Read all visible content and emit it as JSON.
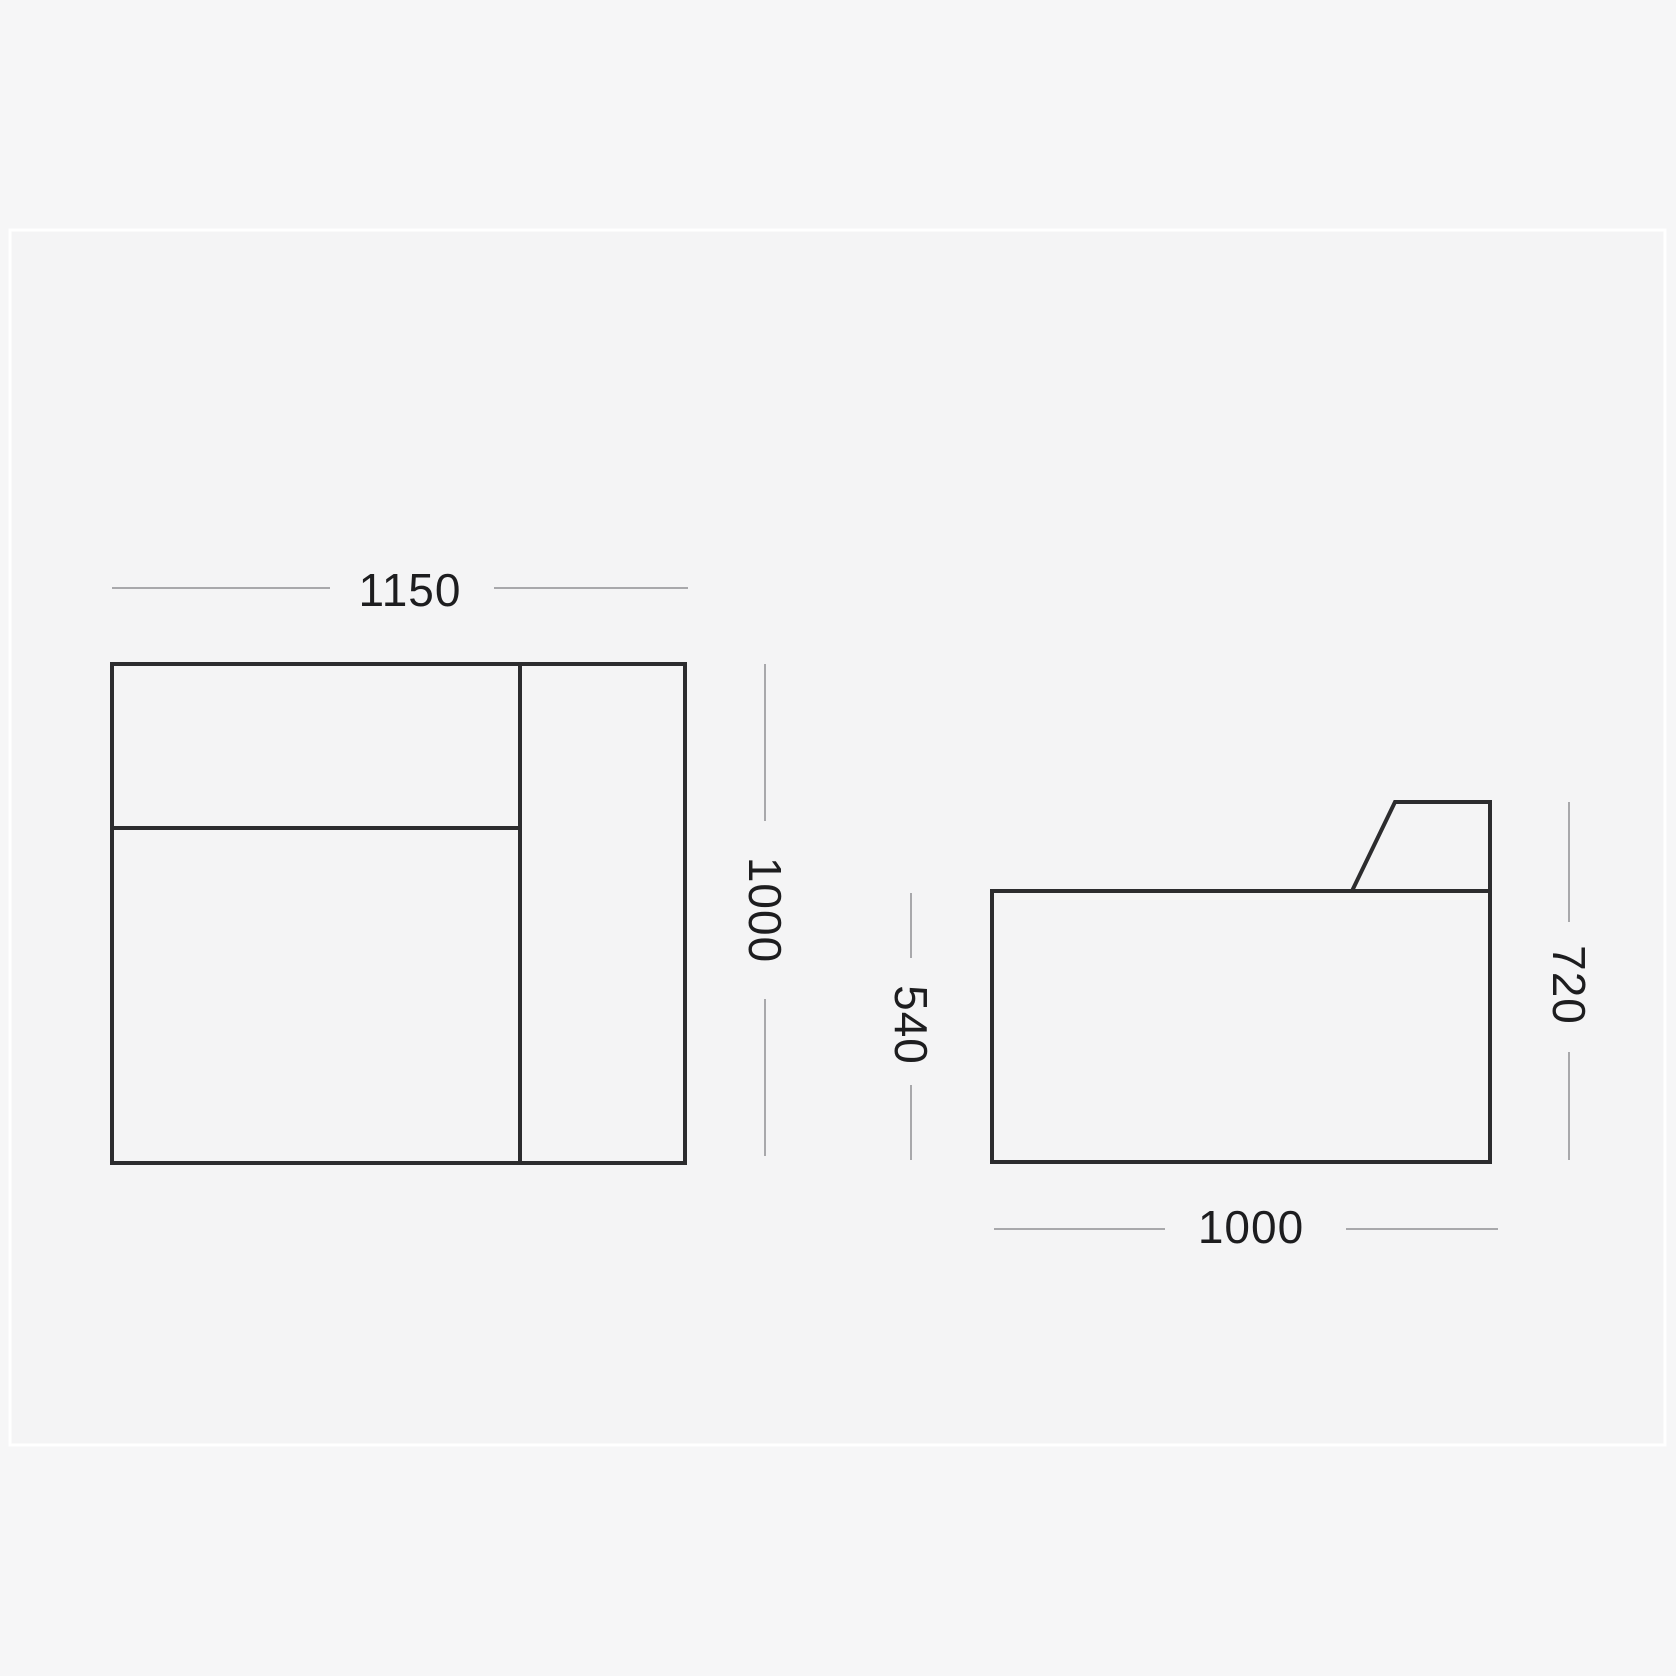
{
  "diagram": {
    "top_view": {
      "width_label": "1150",
      "depth_label": "1000"
    },
    "side_view": {
      "seat_height_label": "540",
      "overall_height_label": "720",
      "depth_label": "1000"
    },
    "colors": {
      "page_background": "#f6f6f7",
      "card_background": "#f4f4f5",
      "card_separator": "#ffffff",
      "shape_outline": "#2c2c2e",
      "dimension_line": "#a8a8ab",
      "dimension_text": "#1d1d1f"
    }
  }
}
